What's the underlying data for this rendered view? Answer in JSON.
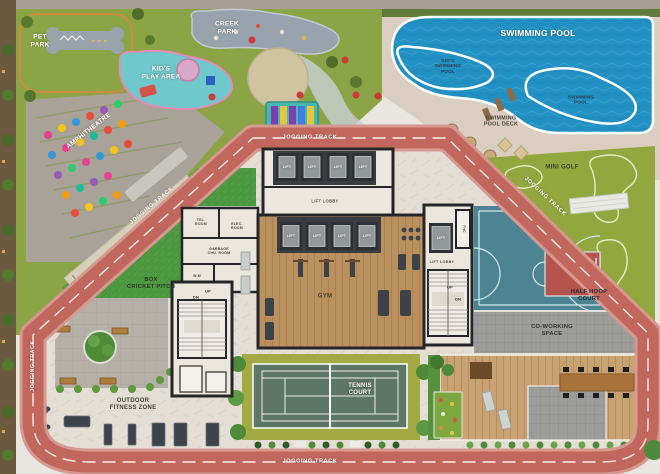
{
  "plan": {
    "type": "amenity-site-plan",
    "labels": {
      "pet_park": "PET\nPARK",
      "creek_park": "CREEK\nPARK",
      "kids_play_area": "KID'S\nPLAY AREA",
      "amphitheatre": "AMPHITHEATRE",
      "swimming_pool": "SWIMMING POOL",
      "kids_swimming_pool": "KID'S\nSWIMMING\nPOOL",
      "swimming_pool_small": "SWIMMING\nPOOL",
      "swimming_pool_deck": "SWIMMING\nPOOL DECK",
      "mini_golf": "MINI GOLF",
      "jogging_track": "JOGGING TRACK",
      "box_cricket_pitch": "BOX\nCRICKET PITCH",
      "gym": "GYM",
      "tennis_court": "TENNIS\nCOURT",
      "half_hoop_court": "HALF HOOP\nCOURT",
      "co_working_space": "CO-WORKING\nSPACE",
      "outdoor_fitness_zone": "OUTDOOR\nFITNESS ZONE",
      "lift": "LIFT",
      "lift_lobby": "LIFT LOBBY",
      "tel_room": "TEL.\nROOM",
      "elec_room": "ELEC.\nROOM",
      "garbage_chute_room": "GARBAGE\nCHU. ROOM",
      "wm": "W.M",
      "fhc": "FHC",
      "up": "UP",
      "dn": "DN"
    },
    "colors": {
      "jogging_track": "#c2675e",
      "track_edge": "#d5998f",
      "pool_water": "#2191c4",
      "pool_deck": "#d9cec0",
      "park_grass": "#8aa446",
      "turf_green": "#4f9b43",
      "mini_golf_green": "#92a83f",
      "gym_wood": "#bb905f",
      "deck_wood": "#c9a273",
      "tennis_court": "#5e7667",
      "tennis_apron": "#a3aa44",
      "basketball_teal": "#4d8494",
      "basketball_red": "#b5534d",
      "paver_gray": "#9d9d9b",
      "deck_inner": "#e4ded4"
    }
  }
}
